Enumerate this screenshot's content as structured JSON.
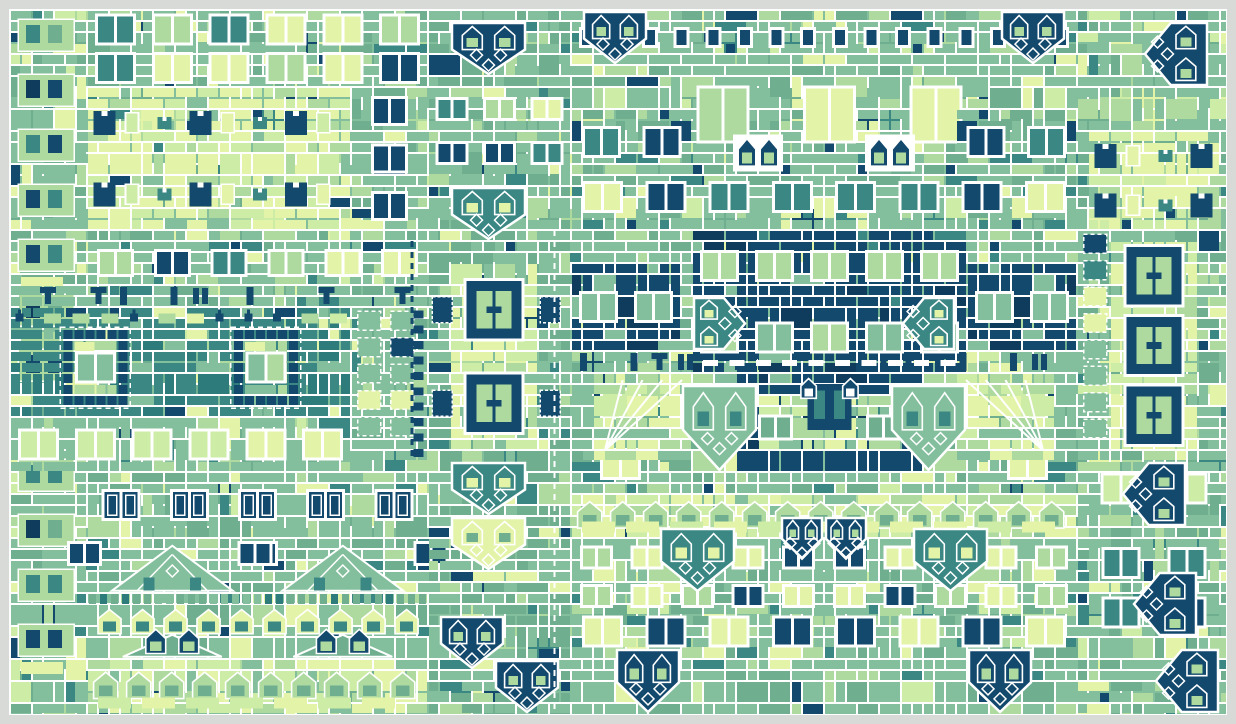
{
  "artwork": {
    "type": "generative-mosaic-quilt",
    "canvas": {
      "width": 1236,
      "height": 724,
      "margin": 10,
      "unit": 11,
      "cols": 110,
      "rows": 64,
      "mirror_axis_col": 74,
      "seed": 20240907
    },
    "palette": {
      "background": "#d8dad8",
      "line": "#ffffff",
      "base": "#84bf9d",
      "sage": "#6fae8e",
      "light": "#aedaa0",
      "lime": "#cdeca6",
      "pale": "#e3f4a9",
      "teal": "#3a8784",
      "tealDark": "#2e7b7c",
      "navy": "#13496d",
      "navyDark": "#0f3c5c"
    },
    "presets": {
      "green": [
        [
          "base",
          58
        ],
        [
          "sage",
          14
        ],
        [
          "light",
          12
        ],
        [
          "pale",
          6
        ],
        [
          "teal",
          4
        ],
        [
          "navy",
          3
        ],
        [
          "lime",
          3
        ]
      ],
      "sage": [
        [
          "sage",
          42
        ],
        [
          "base",
          38
        ],
        [
          "light",
          8
        ],
        [
          "pale",
          5
        ],
        [
          "teal",
          4
        ],
        [
          "navy",
          3
        ]
      ],
      "pale": [
        [
          "pale",
          50
        ],
        [
          "lime",
          22
        ],
        [
          "light",
          16
        ],
        [
          "base",
          8
        ],
        [
          "teal",
          2
        ],
        [
          "navy",
          2
        ]
      ],
      "paleMix": [
        [
          "pale",
          40
        ],
        [
          "lime",
          30
        ],
        [
          "light",
          20
        ],
        [
          "base",
          10
        ]
      ],
      "teal": [
        [
          "teal",
          60
        ],
        [
          "tealDark",
          16
        ],
        [
          "base",
          12
        ],
        [
          "pale",
          7
        ],
        [
          "navy",
          5
        ]
      ],
      "navy": [
        [
          "navy",
          80
        ],
        [
          "navyDark",
          10
        ],
        [
          "teal",
          5
        ],
        [
          "base",
          5
        ]
      ],
      "light": [
        [
          "light",
          45
        ],
        [
          "base",
          33
        ],
        [
          "pale",
          12
        ],
        [
          "lime",
          10
        ]
      ]
    },
    "patches": [
      {
        "g": "base",
        "s": "edgecol",
        "c": 0,
        "r": 0,
        "w": 7,
        "h": 64
      },
      {
        "g": "base",
        "s": "windows",
        "c": 7,
        "r": 0,
        "w": 31,
        "h": 7,
        "o": {
          "rows": 2,
          "wc": "mix"
        }
      },
      {
        "g": "base",
        "s": "palepanel",
        "c": 7,
        "r": 7,
        "w": 24,
        "h": 13
      },
      {
        "g": "base",
        "s": "windows",
        "c": 31,
        "r": 7,
        "w": 7,
        "h": 13,
        "o": {
          "rows": 3,
          "wc": "navy"
        }
      },
      {
        "g": "base",
        "s": "windows",
        "c": 7,
        "r": 20,
        "w": 31,
        "h": 6,
        "o": {
          "rows": 1,
          "wc": "mix2"
        }
      },
      {
        "g": "base",
        "s": "glyphrow",
        "c": 0,
        "r": 25,
        "w": 38,
        "h": 2
      },
      {
        "g": "base",
        "s": "tealband",
        "c": 0,
        "r": 27,
        "w": 31,
        "h": 10
      },
      {
        "g": "base",
        "s": "dashed",
        "c": 31,
        "r": 27,
        "w": 7,
        "h": 14
      },
      {
        "g": "base",
        "s": "windows",
        "c": 0,
        "r": 37,
        "w": 31,
        "h": 5,
        "o": {
          "rows": 1,
          "wc": "palePair"
        }
      },
      {
        "g": "base",
        "s": "windows",
        "c": 7,
        "r": 42,
        "w": 31,
        "h": 6,
        "o": {
          "rows": 1,
          "wc": "navyframe"
        }
      },
      {
        "g": "base",
        "s": "houses",
        "c": 7,
        "r": 48,
        "w": 31,
        "h": 11
      },
      {
        "g": "base",
        "s": "archrow",
        "c": 7,
        "r": 59,
        "w": 31,
        "h": 5,
        "o": {
          "pale": true
        }
      },
      {
        "g": "base",
        "s": "grid",
        "c": 38,
        "r": 0,
        "w": 13,
        "h": 64,
        "o": {
          "p": "sage"
        }
      },
      {
        "g": "base",
        "s": "shield",
        "c": 40,
        "r": 1,
        "w": 7,
        "h": 5,
        "o": {
          "dir": "down",
          "color": "navy"
        }
      },
      {
        "g": "base",
        "s": "windows",
        "c": 38,
        "r": 7,
        "w": 13,
        "h": 8,
        "o": {
          "rows": 2,
          "wc": "mixSmall"
        }
      },
      {
        "g": "base",
        "s": "shield",
        "c": 40,
        "r": 16,
        "w": 7,
        "h": 5,
        "o": {
          "dir": "down",
          "color": "teal"
        }
      },
      {
        "g": "base",
        "s": "palecol",
        "c": 40,
        "r": 23,
        "w": 8,
        "h": 17,
        "o": {
          "flanks": true
        }
      },
      {
        "g": "base",
        "s": "shield",
        "c": 40,
        "r": 41,
        "w": 7,
        "h": 5,
        "o": {
          "dir": "down",
          "color": "teal"
        }
      },
      {
        "g": "base",
        "s": "shield",
        "c": 40,
        "r": 46,
        "w": 7,
        "h": 5,
        "o": {
          "dir": "down",
          "color": "pale"
        }
      },
      {
        "g": "base",
        "s": "shield",
        "c": 39,
        "r": 55,
        "w": 6,
        "h": 5,
        "o": {
          "dir": "down",
          "color": "navy"
        }
      },
      {
        "g": "base",
        "s": "shield",
        "c": 44,
        "r": 59,
        "w": 6,
        "h": 5,
        "o": {
          "dir": "down",
          "color": "navy"
        }
      },
      {
        "g": "base",
        "s": "windows",
        "c": 60,
        "r": 5,
        "w": 29,
        "h": 9,
        "o": {
          "rows": 1,
          "wc": "paleBig"
        }
      },
      {
        "g": "base",
        "s": "glyphrow",
        "c": 51,
        "r": 31,
        "w": 46,
        "h": 2
      },
      {
        "g": "base",
        "s": "navyblock",
        "c": 62,
        "r": 20,
        "w": 25,
        "h": 13,
        "o": {
          "dashes": true
        }
      },
      {
        "g": "base",
        "s": "navyblock",
        "c": 66,
        "r": 33,
        "w": 17,
        "h": 9,
        "o": {
          "courtyard": true
        }
      },
      {
        "g": "base",
        "s": "archrow",
        "c": 51,
        "r": 44,
        "w": 46,
        "h": 4,
        "o": {
          "pale": true
        }
      },
      {
        "g": "half",
        "s": "windows",
        "c": 51,
        "r": 0,
        "w": 23,
        "h": 5,
        "o": {
          "rows": 1,
          "wc": "navySmall"
        }
      },
      {
        "g": "half",
        "s": "shield",
        "c": 52,
        "r": 0,
        "w": 6,
        "h": 5,
        "o": {
          "dir": "down",
          "color": "navy"
        }
      },
      {
        "g": "half",
        "s": "windows",
        "c": 51,
        "r": 9,
        "w": 11,
        "h": 6,
        "o": {
          "rows": 1,
          "wc": "teal"
        }
      },
      {
        "g": "half",
        "s": "windows",
        "c": 51,
        "r": 14,
        "w": 23,
        "h": 6,
        "o": {
          "rows": 1,
          "wc": "mix"
        }
      },
      {
        "g": "half",
        "s": "archpair",
        "c": 66,
        "r": 11,
        "w": 4,
        "h": 4
      },
      {
        "g": "half",
        "s": "windows",
        "c": 51,
        "r": 33,
        "w": 9,
        "h": 11,
        "o": {
          "rows": 2,
          "wc": "palePair"
        }
      },
      {
        "g": "half",
        "s": "navyblock",
        "c": 51,
        "r": 23,
        "w": 10,
        "h": 8,
        "o": {}
      },
      {
        "g": "half",
        "s": "palewing",
        "c": 53,
        "r": 33,
        "w": 9,
        "h": 8
      },
      {
        "g": "half",
        "s": "shield",
        "c": 62,
        "r": 26,
        "w": 5,
        "h": 5,
        "o": {
          "dir": "right",
          "color": "teal"
        }
      },
      {
        "g": "half",
        "s": "shield",
        "c": 61,
        "r": 34,
        "w": 7,
        "h": 8,
        "o": {
          "dir": "down",
          "color": "green"
        }
      },
      {
        "g": "half",
        "s": "windows",
        "c": 51,
        "r": 48,
        "w": 23,
        "h": 7,
        "o": {
          "rows": 2,
          "wc": "mixSmall"
        }
      },
      {
        "g": "half",
        "s": "shield",
        "c": 59,
        "r": 47,
        "w": 7,
        "h": 6,
        "o": {
          "dir": "down",
          "color": "teal"
        }
      },
      {
        "g": "half",
        "s": "shield",
        "c": 70,
        "r": 46,
        "w": 4,
        "h": 4,
        "o": {
          "dir": "down",
          "color": "navy"
        }
      },
      {
        "g": "half",
        "s": "windows",
        "c": 51,
        "r": 55,
        "w": 23,
        "h": 3,
        "o": {
          "rows": 1,
          "wc": "mix"
        }
      },
      {
        "g": "half",
        "s": "shield",
        "c": 55,
        "r": 58,
        "w": 6,
        "h": 6,
        "o": {
          "dir": "down",
          "color": "navy"
        }
      },
      {
        "g": "top",
        "s": "grid",
        "c": 97,
        "r": 0,
        "w": 14,
        "h": 64,
        "o": {
          "p": "green"
        }
      },
      {
        "g": "top",
        "s": "shield",
        "c": 103,
        "r": 1,
        "w": 6,
        "h": 6,
        "o": {
          "dir": "left",
          "color": "navy"
        }
      },
      {
        "g": "top",
        "s": "palepanel",
        "c": 98,
        "r": 11,
        "w": 12,
        "h": 9
      },
      {
        "g": "top",
        "s": "dashed",
        "c": 97,
        "r": 20,
        "w": 3,
        "h": 21
      },
      {
        "g": "top",
        "s": "palecol",
        "c": 100,
        "r": 21,
        "w": 8,
        "h": 19,
        "o": {}
      },
      {
        "g": "top",
        "s": "windows",
        "c": 98,
        "r": 41,
        "w": 12,
        "h": 5,
        "o": {
          "rows": 1,
          "wc": "palePair"
        }
      },
      {
        "g": "top",
        "s": "shield",
        "c": 101,
        "r": 41,
        "w": 6,
        "h": 6,
        "o": {
          "dir": "left",
          "color": "navy"
        }
      },
      {
        "g": "top",
        "s": "windows",
        "c": 98,
        "r": 48,
        "w": 12,
        "h": 9,
        "o": {
          "rows": 2,
          "wc": "teal"
        }
      },
      {
        "g": "top",
        "s": "shield",
        "c": 102,
        "r": 51,
        "w": 6,
        "h": 6,
        "o": {
          "dir": "left",
          "color": "navy"
        }
      },
      {
        "g": "top",
        "s": "shield",
        "c": 104,
        "r": 58,
        "w": 6,
        "h": 6,
        "o": {
          "dir": "left",
          "color": "navy"
        }
      }
    ],
    "separators": [
      {
        "x": 544.5,
        "y1": 220,
        "y2": 704,
        "color": "line",
        "dash": "6 5",
        "width": 2
      },
      {
        "x": 402,
        "y1": 231,
        "y2": 451,
        "color": "navy",
        "dash": "6 5",
        "width": 3
      }
    ]
  }
}
